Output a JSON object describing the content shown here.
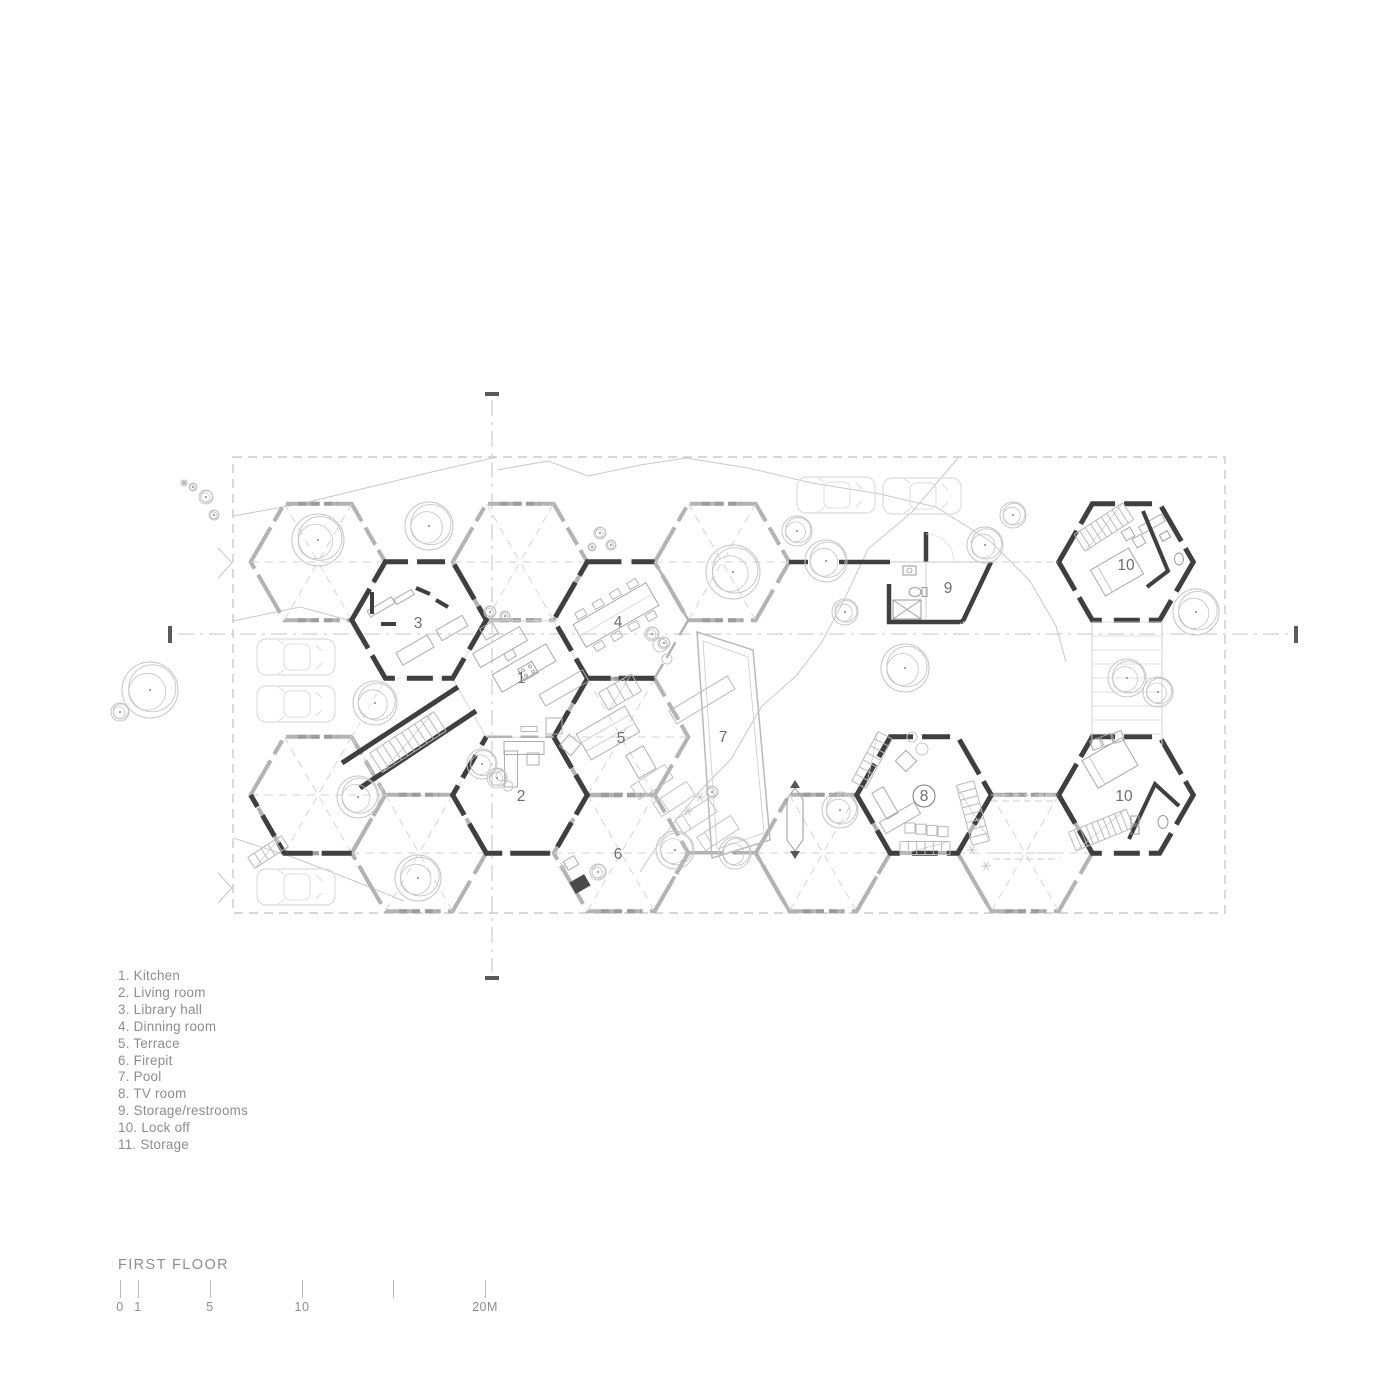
{
  "title": "FIRST FLOOR",
  "legend": [
    {
      "num": "1.",
      "label": "Kitchen"
    },
    {
      "num": "2.",
      "label": "Living room"
    },
    {
      "num": "3.",
      "label": "Library hall"
    },
    {
      "num": "4.",
      "label": "Dinning room"
    },
    {
      "num": "5.",
      "label": "Terrace"
    },
    {
      "num": "6.",
      "label": "Firepit"
    },
    {
      "num": "7.",
      "label": "Pool"
    },
    {
      "num": "8.",
      "label": "TV room"
    },
    {
      "num": "9.",
      "label": "Storage/restrooms"
    },
    {
      "num": "10.",
      "label": "Lock off"
    },
    {
      "num": "11.",
      "label": "Storage"
    }
  ],
  "scale_bar": {
    "ticks": [
      {
        "x": 120,
        "label": "0"
      },
      {
        "x": 138,
        "label": "1"
      },
      {
        "x": 210,
        "label": "5"
      },
      {
        "x": 302,
        "label": "10"
      },
      {
        "x": 393,
        "label": ""
      },
      {
        "x": 485,
        "label": "20M"
      }
    ]
  },
  "colors": {
    "wall": "#3f3f3f",
    "gray_wall": "#b3b3b3",
    "deco": "#c9c9c9",
    "faint": "#dcdcdc",
    "furniture": "#adadad",
    "light_furniture": "#c6c6c6",
    "tree": "#c5c5c5",
    "car": "#dcdcdc",
    "text": "#6e6e6e",
    "muted": "#8d8d8d",
    "boundary": "#c0c0c0",
    "centerline": "#c6c6c6",
    "tick": "#5a5a5a"
  },
  "plan": {
    "hex_radius": 67.3,
    "boundary": {
      "x": 233,
      "y": 457,
      "w": 992,
      "h": 456
    },
    "centerlines": {
      "vx": 492,
      "vy1": 400,
      "vy2": 972,
      "hy": 634,
      "hx1": 178,
      "hx2": 1288
    },
    "hexes": [
      {
        "cx": 318,
        "cy": 562,
        "type": "open"
      },
      {
        "cx": 520,
        "cy": 562,
        "type": "open"
      },
      {
        "cx": 722,
        "cy": 562,
        "type": "open"
      },
      {
        "cx": 419,
        "cy": 620,
        "type": "room",
        "room": "3"
      },
      {
        "cx": 621,
        "cy": 620,
        "type": "room",
        "room": "4",
        "gray_edges": [
          2,
          3
        ]
      },
      {
        "cx": 520,
        "cy": 679,
        "type": "roomopen",
        "room": "1"
      },
      {
        "cx": 621,
        "cy": 737,
        "type": "open",
        "room": "5",
        "dark_edges": [
          0
        ]
      },
      {
        "cx": 520,
        "cy": 795,
        "type": "room",
        "room": "2",
        "gray_edges": [
          1
        ]
      },
      {
        "cx": 318,
        "cy": 795,
        "type": "open",
        "dark_edges": [
          4,
          5
        ]
      },
      {
        "cx": 419,
        "cy": 737,
        "type": "faint"
      },
      {
        "cx": 419,
        "cy": 853,
        "type": "open"
      },
      {
        "cx": 621,
        "cy": 853,
        "type": "open",
        "room": "6"
      },
      {
        "cx": 823,
        "cy": 853,
        "type": "open"
      },
      {
        "cx": 1025,
        "cy": 853,
        "type": "open"
      },
      {
        "cx": 924,
        "cy": 795,
        "type": "room",
        "room": "8"
      },
      {
        "cx": 1126,
        "cy": 562,
        "type": "room",
        "room": "10a"
      },
      {
        "cx": 1126,
        "cy": 795,
        "type": "room",
        "room": "10b"
      },
      {
        "cx": 722,
        "cy": 911,
        "type": "partial"
      },
      {
        "cx": 924,
        "cy": 911,
        "type": "partial"
      }
    ],
    "room_labels": [
      {
        "n": "1",
        "x": 521,
        "y": 683
      },
      {
        "n": "2",
        "x": 521,
        "y": 801
      },
      {
        "n": "3",
        "x": 418,
        "y": 628
      },
      {
        "n": "4",
        "x": 618,
        "y": 627
      },
      {
        "n": "5",
        "x": 621,
        "y": 743
      },
      {
        "n": "6",
        "x": 618,
        "y": 859
      },
      {
        "n": "7",
        "x": 723,
        "y": 742
      },
      {
        "n": "8",
        "x": 924,
        "y": 801,
        "circled": true
      },
      {
        "n": "9",
        "x": 948,
        "y": 593
      },
      {
        "n": "10",
        "x": 1126,
        "y": 570
      },
      {
        "n": "10",
        "x": 1124,
        "y": 801
      }
    ],
    "trees": [
      [
        206,
        497,
        7
      ],
      [
        193,
        487,
        4
      ],
      [
        214,
        515,
        5
      ],
      [
        184,
        483,
        3
      ],
      [
        318,
        540,
        26
      ],
      [
        429,
        526,
        24
      ],
      [
        600,
        533,
        6
      ],
      [
        611,
        545,
        5
      ],
      [
        592,
        547,
        4
      ],
      [
        733,
        572,
        27
      ],
      [
        797,
        531,
        15
      ],
      [
        826,
        561,
        21
      ],
      [
        985,
        545,
        18
      ],
      [
        1013,
        515,
        13
      ],
      [
        905,
        668,
        24
      ],
      [
        845,
        612,
        13
      ],
      [
        1196,
        612,
        23
      ],
      [
        1127,
        678,
        19
      ],
      [
        1158,
        692,
        15
      ],
      [
        150,
        690,
        28
      ],
      [
        120,
        712,
        9
      ],
      [
        375,
        703,
        22
      ],
      [
        358,
        797,
        21
      ],
      [
        418,
        878,
        23
      ],
      [
        482,
        764,
        15
      ],
      [
        497,
        778,
        10
      ],
      [
        652,
        634,
        7
      ],
      [
        664,
        643,
        6
      ],
      [
        490,
        612,
        6
      ],
      [
        505,
        616,
        5
      ],
      [
        675,
        850,
        19
      ],
      [
        735,
        853,
        16
      ],
      [
        840,
        810,
        18
      ],
      [
        712,
        792,
        6
      ],
      [
        598,
        872,
        8
      ]
    ],
    "cars": [
      {
        "x": 296,
        "y": 657
      },
      {
        "x": 296,
        "y": 704
      },
      {
        "x": 296,
        "y": 887
      },
      {
        "x": 836,
        "y": 495
      },
      {
        "x": 922,
        "y": 496
      }
    ],
    "stairs": [
      {
        "x": 408,
        "y": 742,
        "len": 76,
        "w": 23,
        "a": -33,
        "n": 10
      },
      {
        "x": 620,
        "y": 692,
        "len": 38,
        "w": 20,
        "a": -30,
        "n": 4
      },
      {
        "x": 973,
        "y": 813,
        "len": 62,
        "w": 18,
        "a": 75,
        "n": 8
      },
      {
        "x": 872,
        "y": 760,
        "len": 56,
        "w": 16,
        "a": -62,
        "n": 7
      },
      {
        "x": 925,
        "y": 848,
        "len": 50,
        "w": 13,
        "a": 0,
        "n": 6
      },
      {
        "x": 1104,
        "y": 527,
        "len": 58,
        "w": 20,
        "a": -33,
        "n": 9
      },
      {
        "x": 1101,
        "y": 830,
        "len": 62,
        "w": 20,
        "a": -22,
        "n": 10
      },
      {
        "x": 268,
        "y": 852,
        "len": 40,
        "w": 13,
        "a": -33,
        "n": 5
      }
    ],
    "corridor": {
      "wallA": [
        342,
        763,
        458,
        687
      ],
      "wallB": [
        360,
        788,
        476,
        711
      ]
    },
    "pool": {
      "outer": [
        [
          697,
          632
        ],
        [
          753,
          650
        ],
        [
          770,
          840
        ],
        [
          712,
          858
        ]
      ],
      "inner": [
        [
          703,
          641
        ],
        [
          748,
          657
        ],
        [
          764,
          833
        ],
        [
          717,
          849
        ]
      ],
      "bench": {
        "x": 702,
        "y": 700,
        "len": 68,
        "w": 15,
        "a": -31
      },
      "chairs": [
        [
          652,
          782
        ],
        [
          674,
          799
        ],
        [
          696,
          816
        ],
        [
          718,
          833
        ]
      ],
      "chair_len": 40,
      "chair_w": 16,
      "chair_a": -33,
      "float_marker": {
        "x": 795,
        "y": 820
      }
    },
    "boardwalk": {
      "x1": 1092,
      "y1": 622,
      "x2": 1162,
      "y2": 746,
      "step": 14
    },
    "connectors": [
      [
        991,
        795,
        1058,
        795
      ],
      [
        991,
        801,
        1058,
        801
      ],
      [
        993,
        853,
        1060,
        853
      ],
      [
        993,
        859,
        1060,
        859
      ],
      [
        991,
        562,
        1058,
        562
      ]
    ],
    "contours": [
      "233,516 300,504 370,487 440,470 497,457",
      "497,470 548,461 588,476 640,465 686,458 748,468 812,483 880,494 936,507 990,541 1030,581 1056,626 1066,662",
      "958,458 912,512 868,549 845,598 822,642 796,676 762,706 731,759 700,791 676,820 655,849 640,872",
      "233,621 300,607 348,620",
      "233,838 292,857 352,880 404,901"
    ],
    "chevrons": [
      [
        218,
        563
      ],
      [
        218,
        888
      ]
    ],
    "asterisks": [
      [
        972,
        850
      ],
      [
        986,
        866
      ],
      [
        700,
        797
      ],
      [
        688,
        811
      ],
      [
        563,
        867
      ]
    ]
  }
}
